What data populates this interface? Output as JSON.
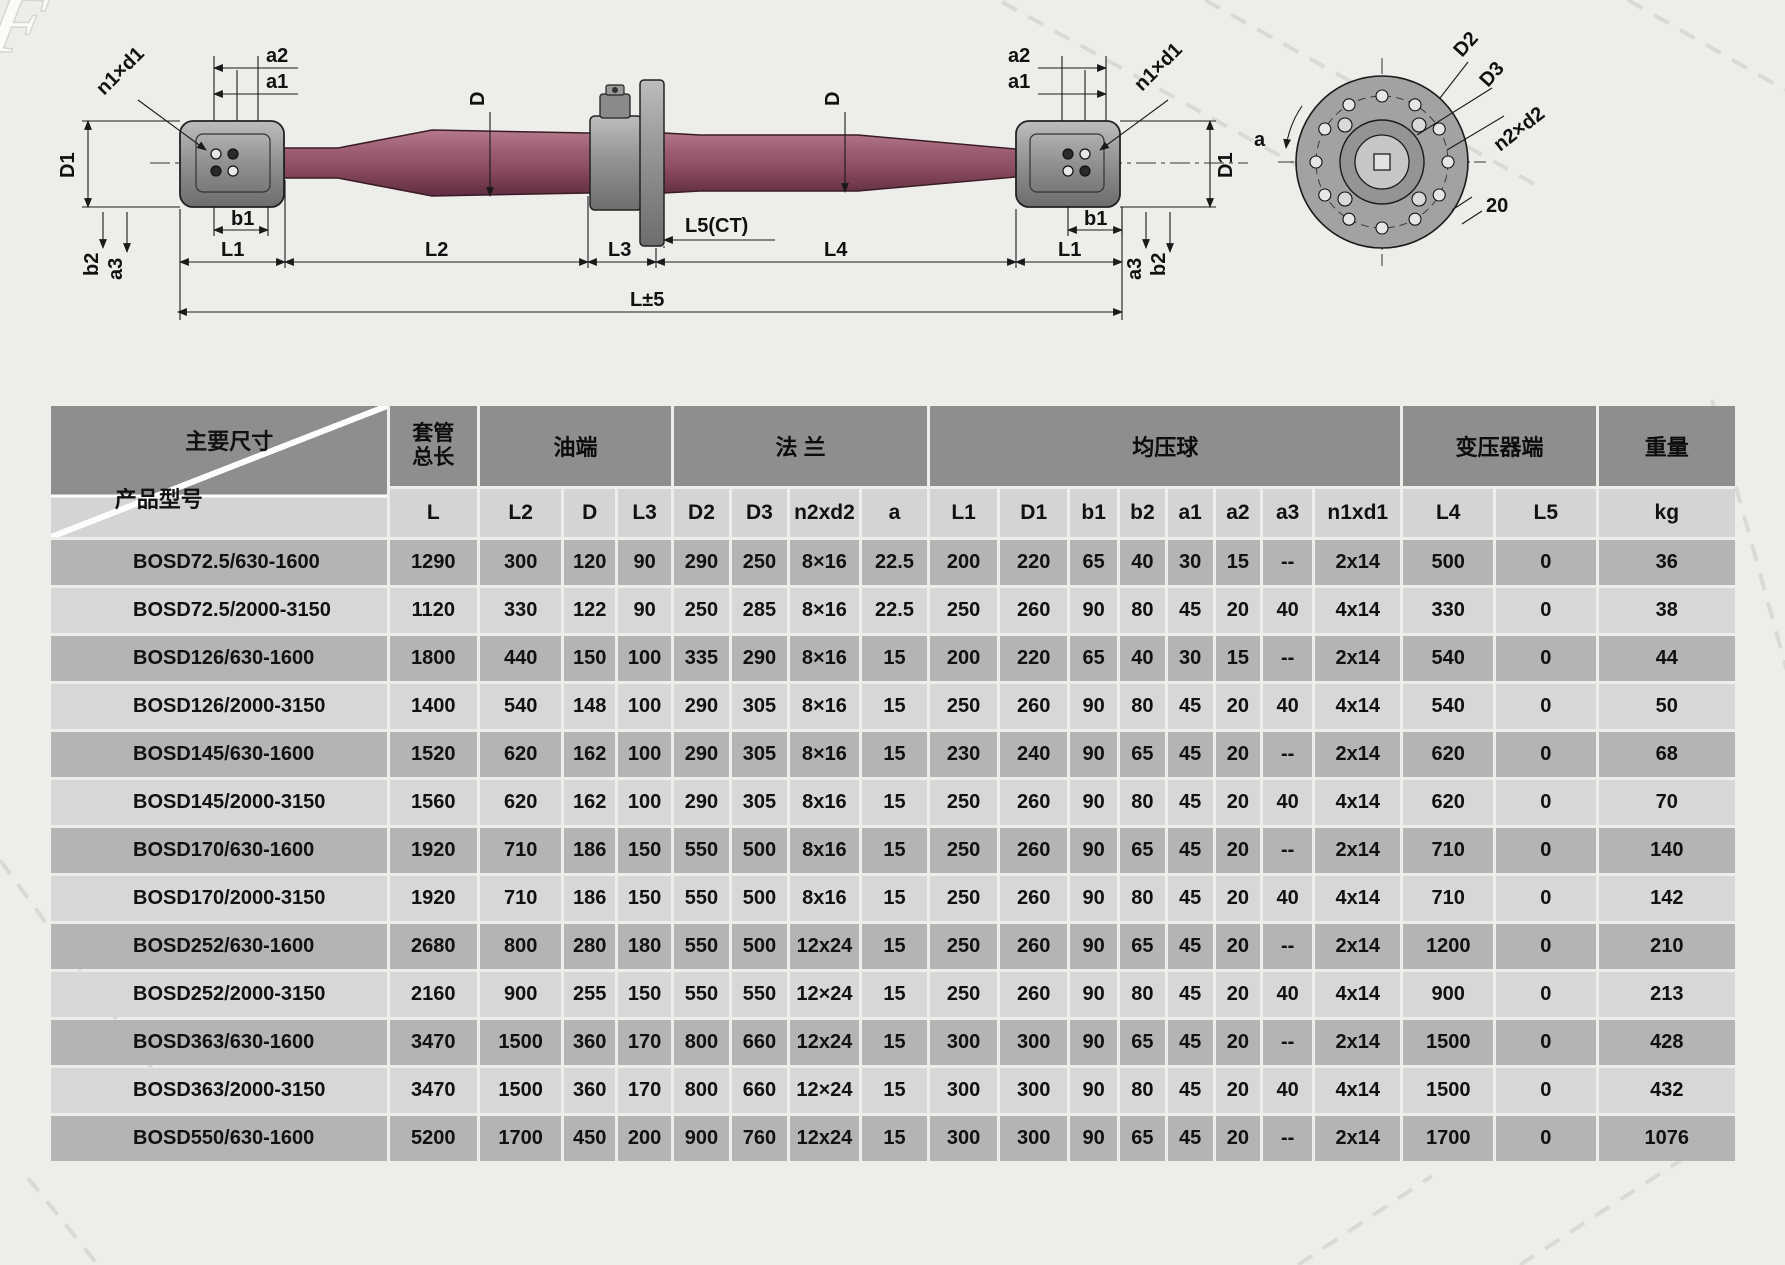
{
  "page": {
    "background_color": "#edeeea",
    "watermark_letter": "F"
  },
  "diagram": {
    "colors": {
      "body_maroon": "#8a4a5f",
      "metal_gray": "#8f8f8f",
      "line": "#1a1a1a"
    },
    "left_end": {
      "a2": "a2",
      "a1": "a1",
      "n1xd1": "n1×d1",
      "D1": "D1",
      "b1": "b1",
      "b2": "b2",
      "a3": "a3",
      "L1": "L1"
    },
    "right_end": {
      "a2": "a2",
      "a1": "a1",
      "n1xd1": "n1×d1",
      "D1": "D1",
      "b1": "b1",
      "b2": "b2",
      "a3": "a3",
      "L1": "L1"
    },
    "center": {
      "D_left": "D",
      "D_right": "D",
      "L2": "L2",
      "L3": "L3",
      "L5": "L5(CT)",
      "L4": "L4",
      "L_total": "L±5"
    },
    "flange_view": {
      "D2": "D2",
      "D3": "D3",
      "n2xd2": "n2×d2",
      "a": "a",
      "dim20": "20"
    }
  },
  "table": {
    "corner": {
      "top": "主要尺寸",
      "bottom": "产品型号"
    },
    "groups": {
      "casing_line1": "套管",
      "casing_line2": "总长",
      "oil_end": "油端",
      "flange": "法 兰",
      "grading_ball": "均压球",
      "transformer_end": "变压器端",
      "weight": "重量"
    },
    "subheaders": [
      "L",
      "L2",
      "D",
      "L3",
      "D2",
      "D3",
      "n2xd2",
      "a",
      "L1",
      "D1",
      "b1",
      "b2",
      "a1",
      "a2",
      "a3",
      "n1xd1",
      "L4",
      "L5",
      "kg"
    ],
    "rows": [
      {
        "model": "BOSD72.5/630-1600",
        "values": [
          "1290",
          "300",
          "120",
          "90",
          "290",
          "250",
          "8×16",
          "22.5",
          "200",
          "220",
          "65",
          "40",
          "30",
          "15",
          "--",
          "2x14",
          "500",
          "0",
          "36"
        ]
      },
      {
        "model": "BOSD72.5/2000-3150",
        "values": [
          "1120",
          "330",
          "122",
          "90",
          "250",
          "285",
          "8×16",
          "22.5",
          "250",
          "260",
          "90",
          "80",
          "45",
          "20",
          "40",
          "4x14",
          "330",
          "0",
          "38"
        ]
      },
      {
        "model": "BOSD126/630-1600",
        "values": [
          "1800",
          "440",
          "150",
          "100",
          "335",
          "290",
          "8×16",
          "15",
          "200",
          "220",
          "65",
          "40",
          "30",
          "15",
          "--",
          "2x14",
          "540",
          "0",
          "44"
        ]
      },
      {
        "model": "BOSD126/2000-3150",
        "values": [
          "1400",
          "540",
          "148",
          "100",
          "290",
          "305",
          "8×16",
          "15",
          "250",
          "260",
          "90",
          "80",
          "45",
          "20",
          "40",
          "4x14",
          "540",
          "0",
          "50"
        ]
      },
      {
        "model": "BOSD145/630-1600",
        "values": [
          "1520",
          "620",
          "162",
          "100",
          "290",
          "305",
          "8×16",
          "15",
          "230",
          "240",
          "90",
          "65",
          "45",
          "20",
          "--",
          "2x14",
          "620",
          "0",
          "68"
        ]
      },
      {
        "model": "BOSD145/2000-3150",
        "values": [
          "1560",
          "620",
          "162",
          "100",
          "290",
          "305",
          "8x16",
          "15",
          "250",
          "260",
          "90",
          "80",
          "45",
          "20",
          "40",
          "4x14",
          "620",
          "0",
          "70"
        ]
      },
      {
        "model": "BOSD170/630-1600",
        "values": [
          "1920",
          "710",
          "186",
          "150",
          "550",
          "500",
          "8x16",
          "15",
          "250",
          "260",
          "90",
          "65",
          "45",
          "20",
          "--",
          "2x14",
          "710",
          "0",
          "140"
        ]
      },
      {
        "model": "BOSD170/2000-3150",
        "values": [
          "1920",
          "710",
          "186",
          "150",
          "550",
          "500",
          "8x16",
          "15",
          "250",
          "260",
          "90",
          "80",
          "45",
          "20",
          "40",
          "4x14",
          "710",
          "0",
          "142"
        ]
      },
      {
        "model": "BOSD252/630-1600",
        "values": [
          "2680",
          "800",
          "280",
          "180",
          "550",
          "500",
          "12x24",
          "15",
          "250",
          "260",
          "90",
          "65",
          "45",
          "20",
          "--",
          "2x14",
          "1200",
          "0",
          "210"
        ]
      },
      {
        "model": "BOSD252/2000-3150",
        "values": [
          "2160",
          "900",
          "255",
          "150",
          "550",
          "550",
          "12×24",
          "15",
          "250",
          "260",
          "90",
          "80",
          "45",
          "20",
          "40",
          "4x14",
          "900",
          "0",
          "213"
        ]
      },
      {
        "model": "BOSD363/630-1600",
        "values": [
          "3470",
          "1500",
          "360",
          "170",
          "800",
          "660",
          "12x24",
          "15",
          "300",
          "300",
          "90",
          "65",
          "45",
          "20",
          "--",
          "2x14",
          "1500",
          "0",
          "428"
        ]
      },
      {
        "model": "BOSD363/2000-3150",
        "values": [
          "3470",
          "1500",
          "360",
          "170",
          "800",
          "660",
          "12×24",
          "15",
          "300",
          "300",
          "90",
          "80",
          "45",
          "20",
          "40",
          "4x14",
          "1500",
          "0",
          "432"
        ]
      },
      {
        "model": "BOSD550/630-1600",
        "values": [
          "5200",
          "1700",
          "450",
          "200",
          "900",
          "760",
          "12x24",
          "15",
          "300",
          "300",
          "90",
          "65",
          "45",
          "20",
          "--",
          "2x14",
          "1700",
          "0",
          "1076"
        ]
      }
    ]
  }
}
